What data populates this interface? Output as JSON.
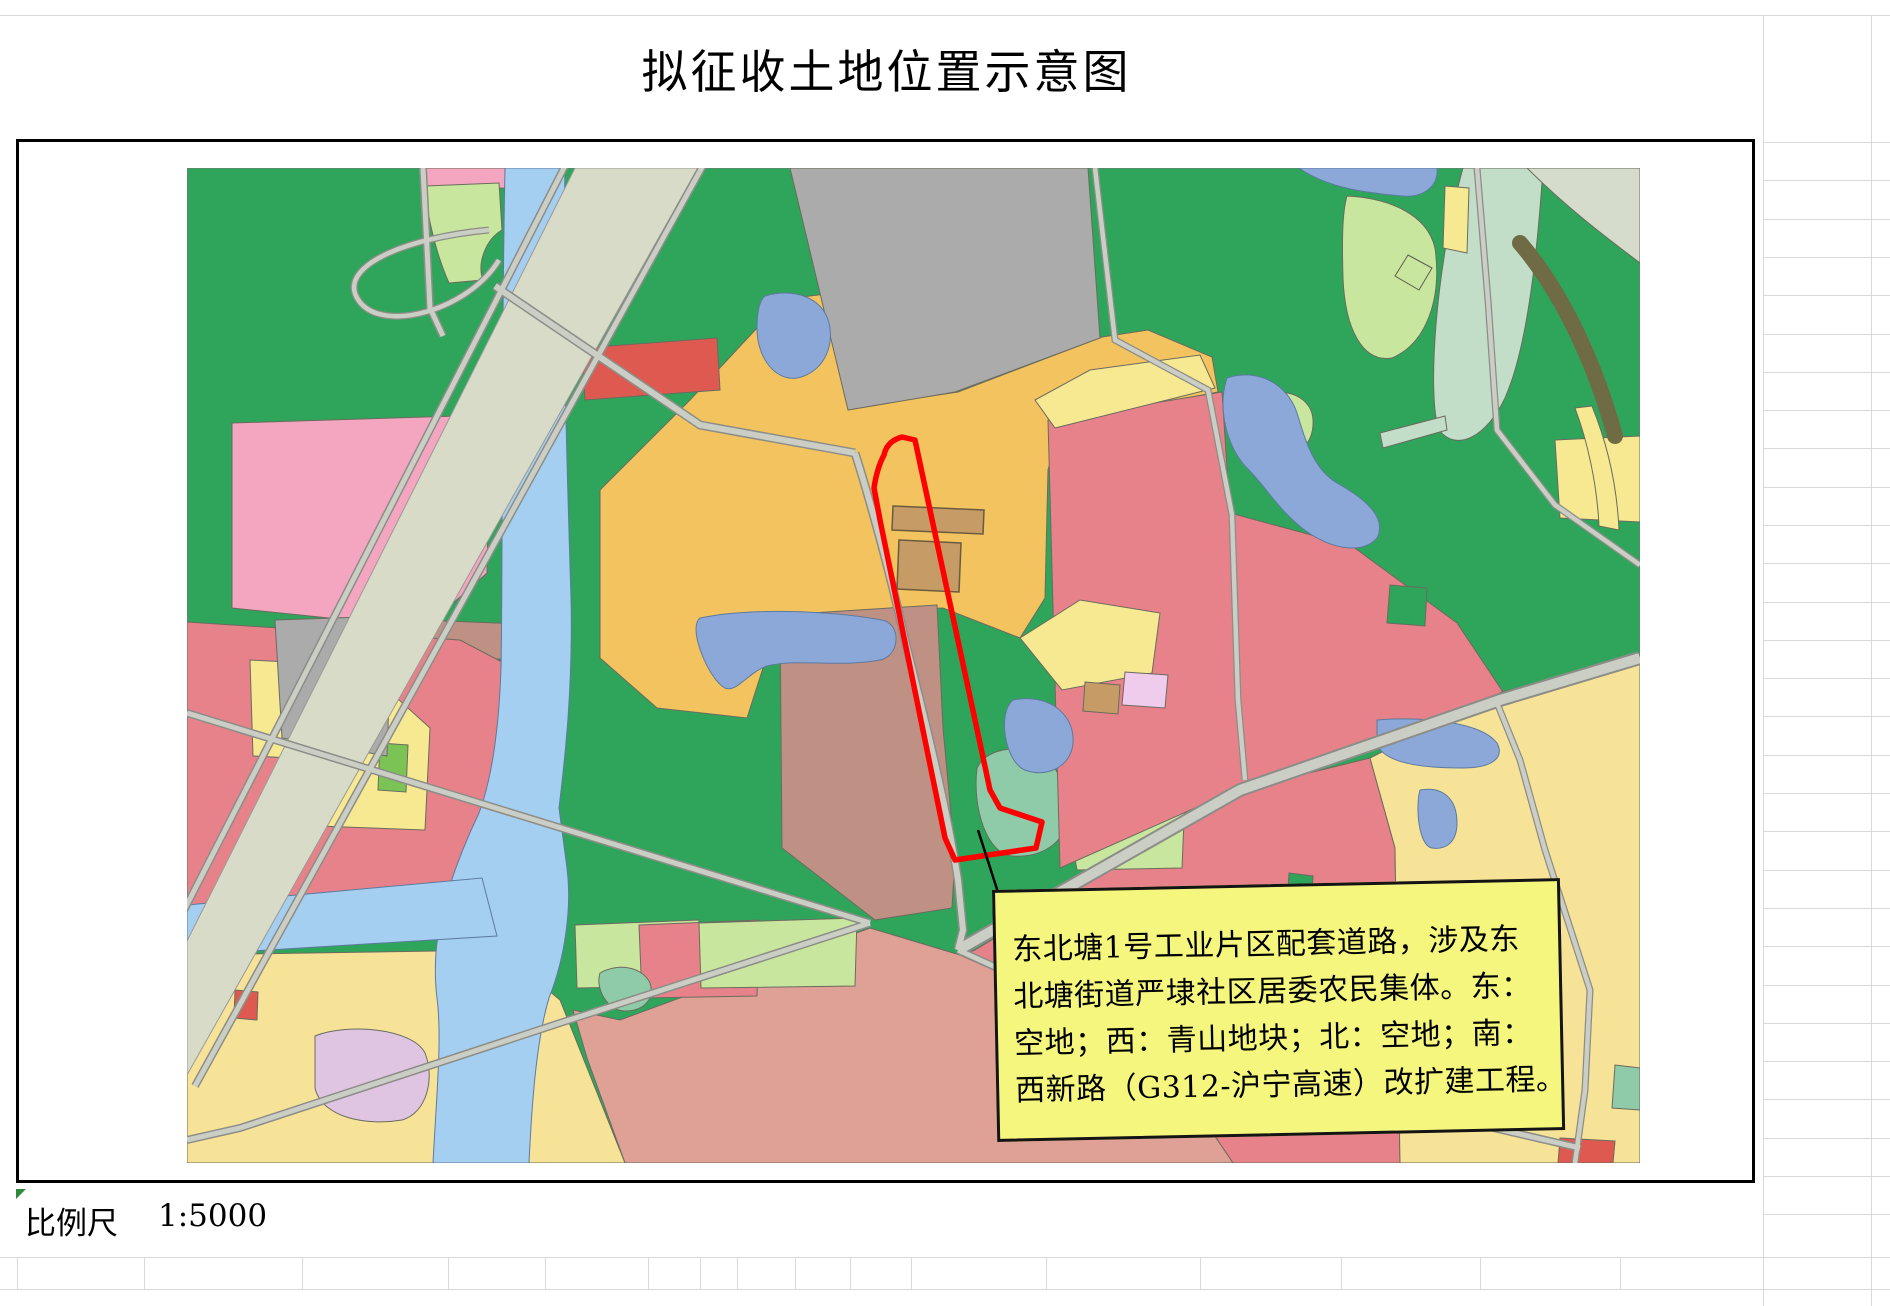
{
  "title": {
    "text": "拟征收土地位置示意图"
  },
  "callout": {
    "lines": [
      "东北塘1号工业片区配套道路，涉及东",
      "北塘街道严埭社区居委农民集体。东：",
      "空地；西：青山地块；北：空地；南：",
      "西新路（G312-沪宁高速）改扩建工程。"
    ]
  },
  "scale_bar": {
    "label": "比例尺",
    "value": "1:5000"
  },
  "map": {
    "highlight_outline_color": "#FF0000",
    "callout_fill_color": "#F5F67D",
    "palette": {
      "green": "#2FA55B",
      "orange": "#F2C35E",
      "paleyellow": "#F6E992",
      "yellowbl": "#F7E398",
      "grayp": "#ABABAB",
      "hwy": "#D7DBC8",
      "roadfill": "#CBCEC4",
      "roadcase": "#8D8D88",
      "river": "#A5CFF1",
      "pond": "#8CA8D8",
      "pinkbright": "#F4A6C0",
      "pinkred": "#E8828A",
      "salmon": "#DFA096",
      "mauve": "#BE9184",
      "tanb": "#C69B66",
      "ltgreen": "#C9E69E",
      "teal": "#8FCBA8",
      "mint": "#C2DEC8",
      "palesage": "#D6DCCB",
      "violet": "#EFCBEC",
      "lavender": "#DFC5E2",
      "btgreen": "#7CC356",
      "redparcel": "#DE5A50",
      "orangeparcel": "#E58450",
      "olive": "#6F6C45"
    }
  }
}
